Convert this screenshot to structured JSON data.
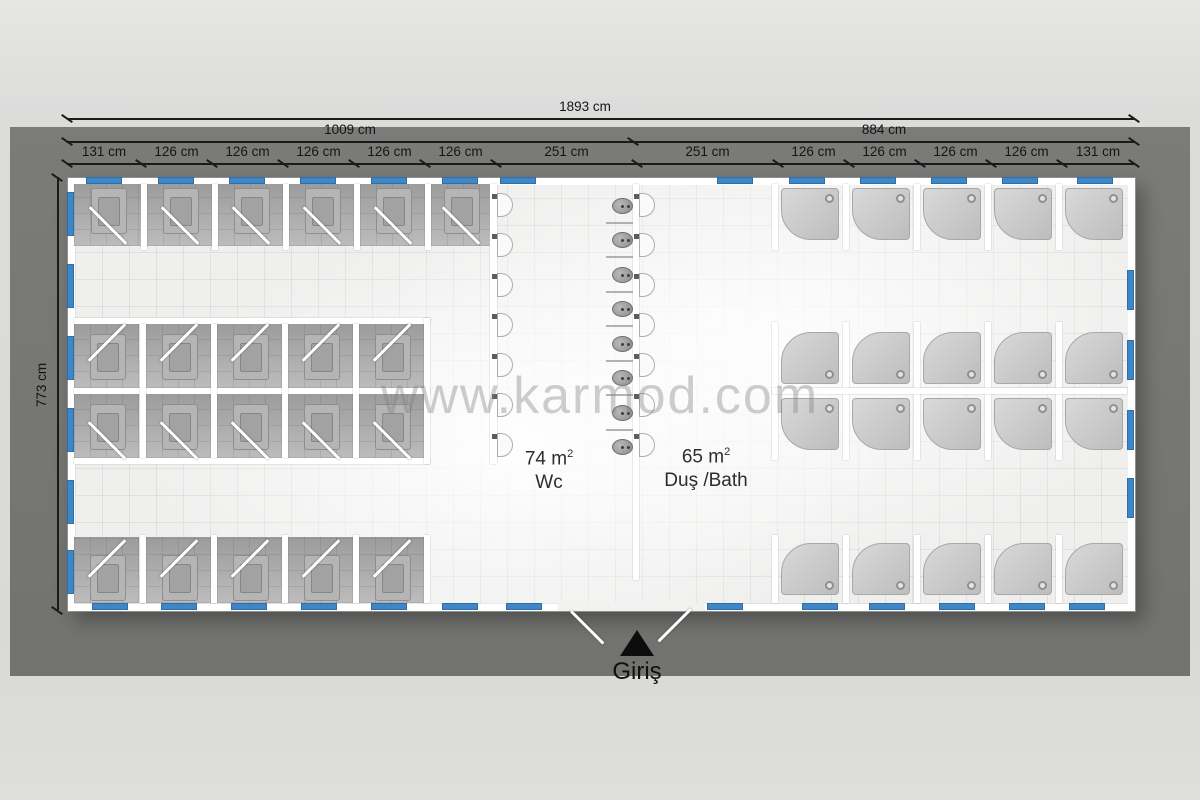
{
  "watermark": "www.karmod.com",
  "dimensions": {
    "overall_width": "1893 cm",
    "left_section_width": "1009 cm",
    "right_section_width": "884 cm",
    "building_height": "773 cm",
    "top_segments": [
      "131 cm",
      "126 cm",
      "126 cm",
      "126 cm",
      "126 cm",
      "126 cm",
      "251 cm",
      "251 cm",
      "126 cm",
      "126 cm",
      "126 cm",
      "126 cm",
      "131 cm"
    ]
  },
  "rooms": [
    {
      "area_value": "74 m",
      "area_sup": "2",
      "label": "Wc"
    },
    {
      "area_value": "65 m",
      "area_sup": "2",
      "label": "Duş /Bath"
    }
  ],
  "entrance": {
    "label": "Giriş"
  },
  "fixtures": {
    "wc_stalls_top_row": 6,
    "wc_stalls_middle_block": 10,
    "wc_stalls_bottom_row": 5,
    "washbasins_wc_side": 7,
    "washbasins_bath_side": 7,
    "urinals": 8,
    "showers_top_row": 5,
    "showers_middle_block": 10,
    "showers_bottom_row": 5
  },
  "colors": {
    "window_blue": "#3d87c9",
    "backdrop_gray": "#7b7b79",
    "wall_white": "#ffffff",
    "floor_tile": "#f2f2f1",
    "stall_gray": "#a3a3a3"
  }
}
